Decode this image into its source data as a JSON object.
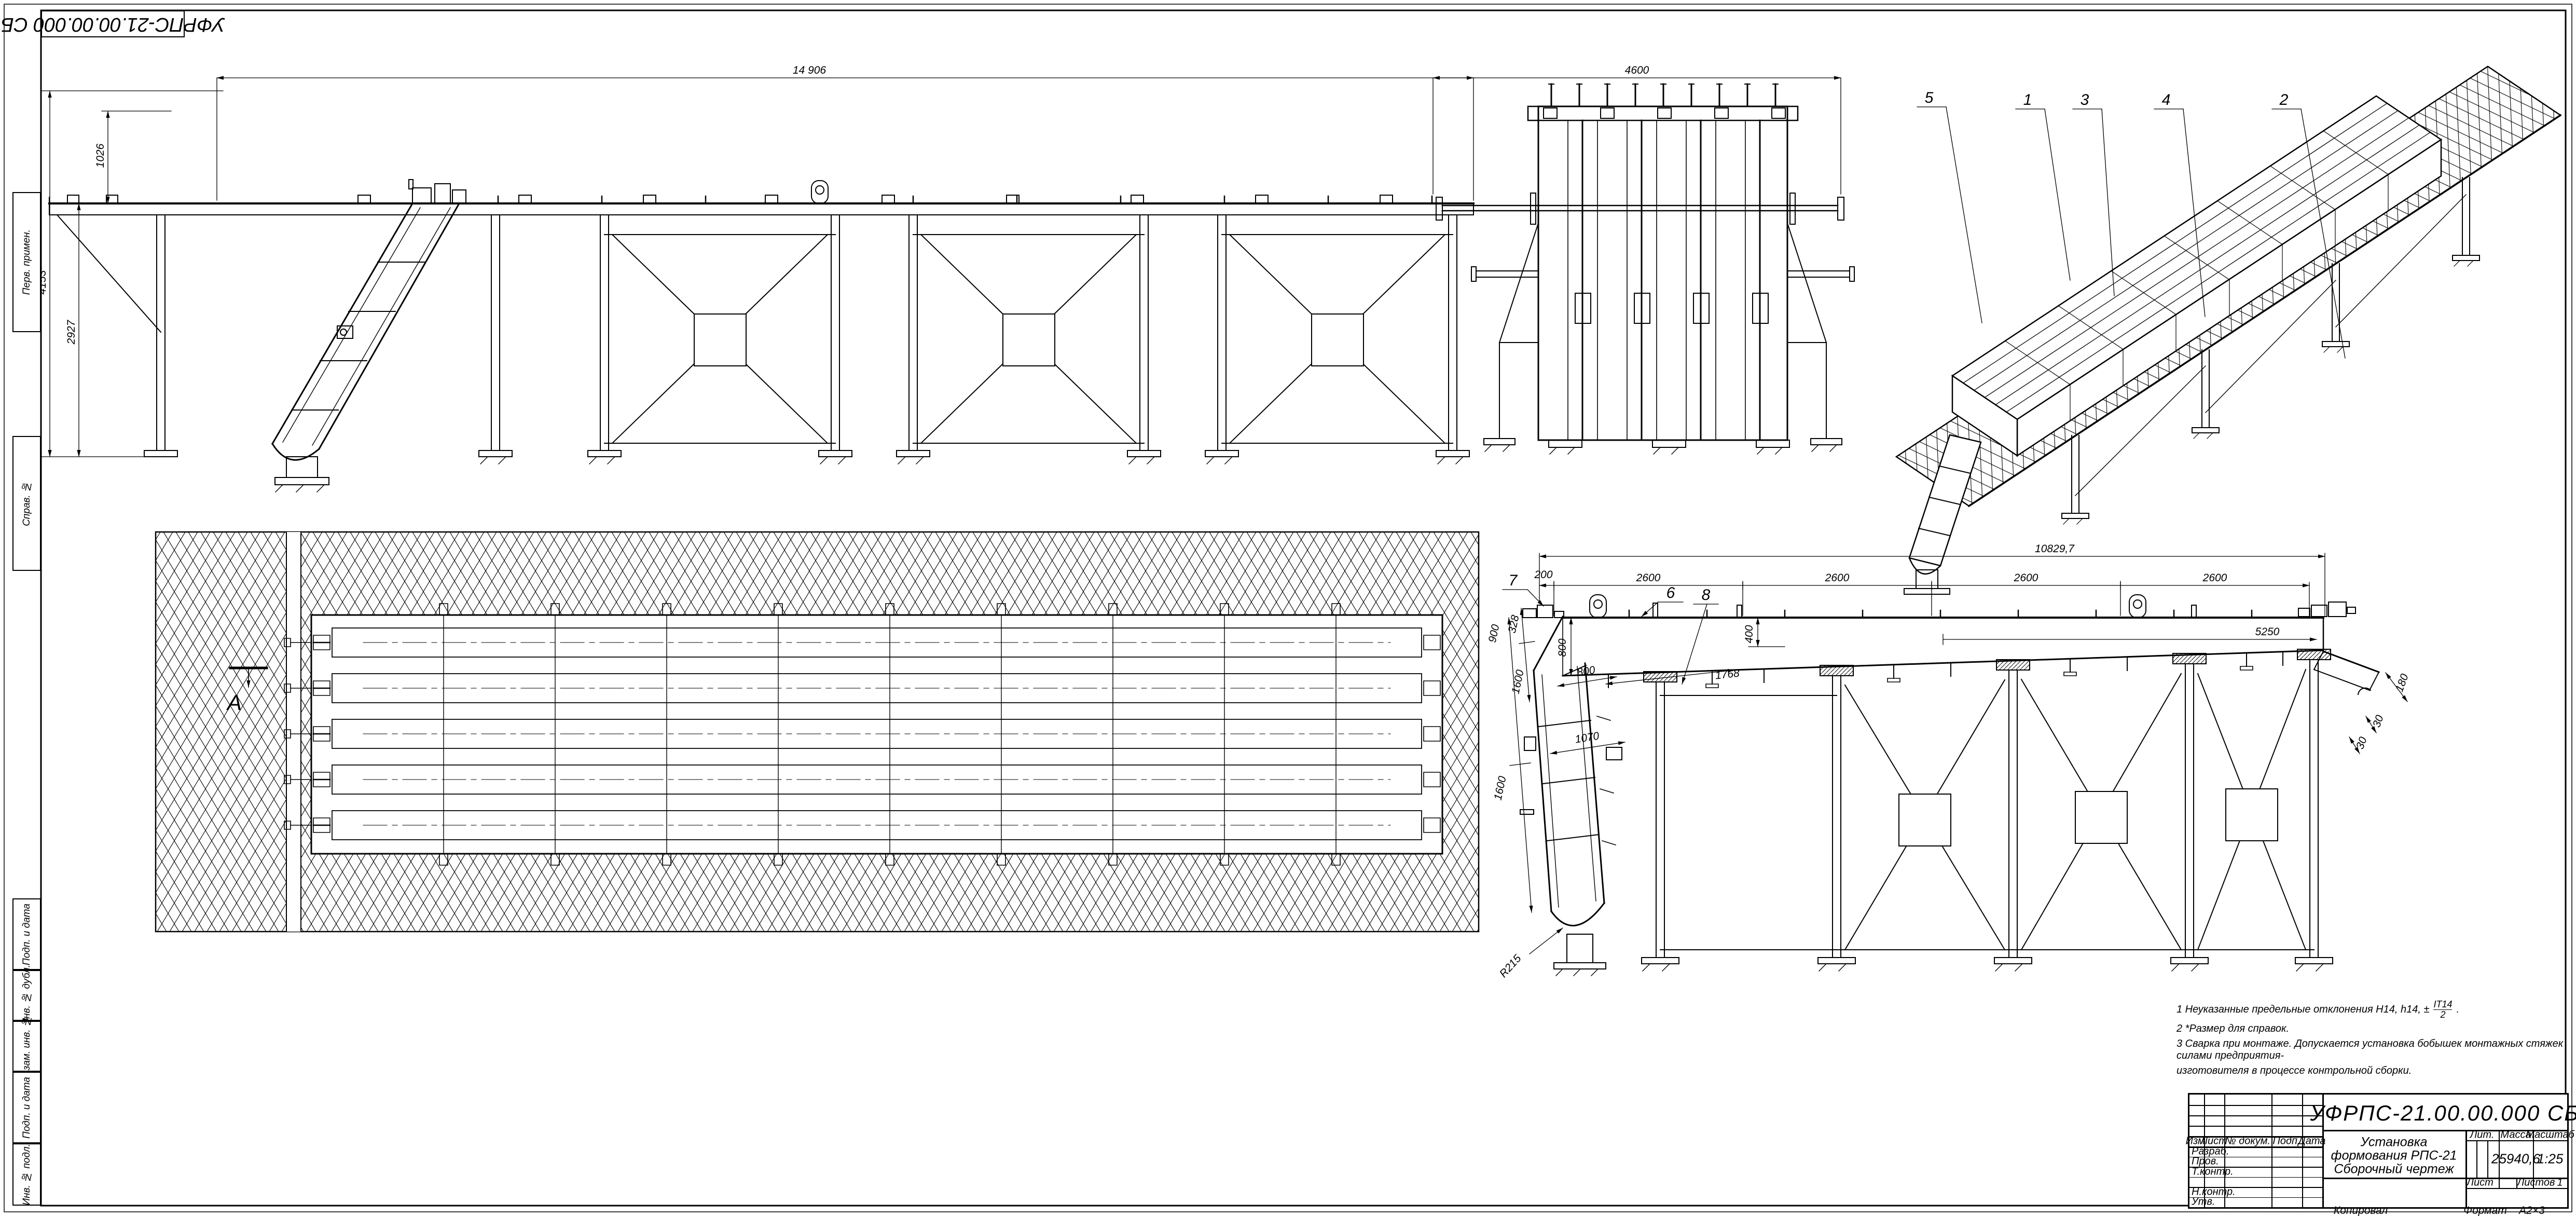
{
  "sheet": {
    "corner_code": "УФРПС-21.00.00.000 СБ",
    "kopiroval": "Копировал",
    "format_label": "Формат",
    "format_value": "А2×3"
  },
  "views": {
    "side_top": {
      "dim_overall": "14 906",
      "dim_height_total": "4153*",
      "dim_height_deck": "2927",
      "dim_height_upper": "1026"
    },
    "end_view": {
      "dim_width": "4600"
    },
    "iso": {
      "callouts": {
        "c5": "5",
        "c1": "1",
        "c3": "3",
        "c4": "4",
        "c2": "2"
      }
    },
    "plan": {
      "section_label": "А"
    },
    "section": {
      "dim_overall": "10829,7",
      "dim_offset": "200",
      "dim_bay1": "2600",
      "dim_bay2": "2600",
      "dim_bay3": "2600",
      "dim_bay4": "2600",
      "dim_5250": "5250",
      "dim_800_left": "800",
      "dim_400": "400",
      "dim_1768": "1768",
      "dim_900": "900",
      "dim_328": "328",
      "dim_1600_a": "1600",
      "dim_1600_b": "1600",
      "dim_800_across": "800",
      "dim_1070": "1070",
      "dim_r215": "R215",
      "dim_180": "180",
      "dim_30_a": "30",
      "dim_30_b": "30",
      "callouts": {
        "c6": "6",
        "c7": "7",
        "c8": "8"
      }
    }
  },
  "notes": {
    "n1_prefix": "1  Неуказанные предельные отклонения Н14, h14, ±",
    "n1_frac_num": "IT14",
    "n1_frac_den": "2",
    "n1_suffix": ".",
    "n2": "2  *Размер для справок.",
    "n3_line1": "3  Сварка при монтаже. Допускается установка бобышек монтажных стяжек силами предприятия-",
    "n3_line2": "изготовителя в процессе контрольной сборки."
  },
  "title_block": {
    "doc_code": "УФРПС-21.00.00.000 СБ",
    "name_line1": "Установка",
    "name_line2": "формования РПС-21",
    "name_line3": "Сборочный чертеж",
    "col_izm": "Изм.",
    "col_list": "Лист",
    "col_docnum": "№ докум.",
    "col_podp": "Подп.",
    "col_data": "Дата",
    "row_razrab": "Разраб.",
    "row_prov": "Пров.",
    "row_tkontr": "Т.контр.",
    "row_nkontr": "Н.контр.",
    "row_utv": "Утв.",
    "lit_label": "Лит.",
    "massa_label": "Масса",
    "masshtab_label": "Масштаб",
    "massa_value": "25940,6",
    "scale_value": "1:25",
    "list_label": "Лист",
    "listov_label": "Листов",
    "listov_value": "1"
  },
  "margin_blocks": {
    "perv_primen": "Перв. примен.",
    "sprav_no": "Справ. №",
    "podp_data_1": "Подп. и дата",
    "inv_dubl": "Инв. № дубл.",
    "vzam_inv": "Взам. инв. №",
    "podp_data_2": "Подп. и дата",
    "inv_podl": "Инв. № подл."
  }
}
